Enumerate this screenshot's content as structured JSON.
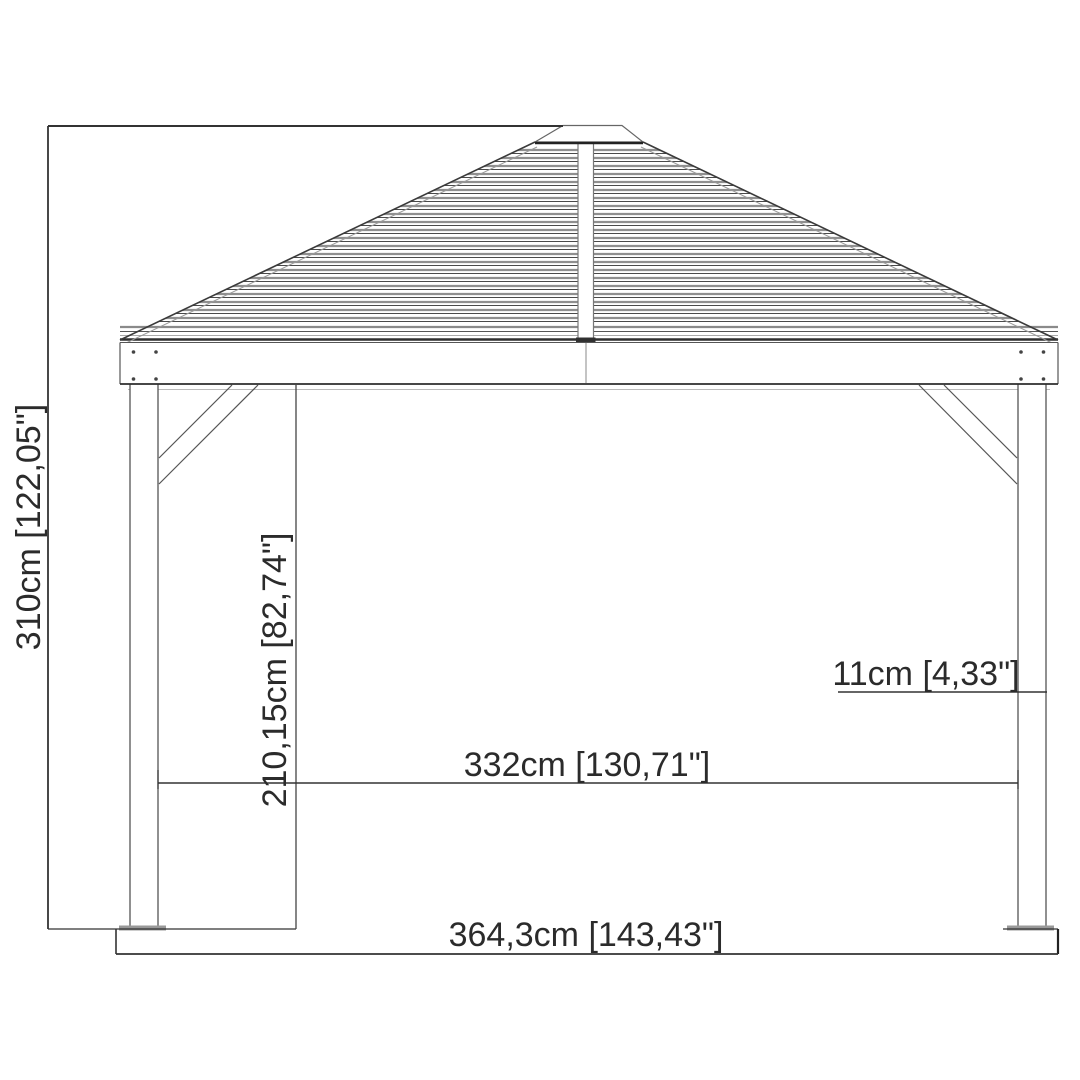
{
  "diagram": {
    "type": "technical-elevation-drawing",
    "subject": "gazebo",
    "dimensions": {
      "total_height": "310cm [122,05\"]",
      "clear_height": "210,15cm [82,74\"]",
      "inner_width": "332cm [130,71\"]",
      "post_width": "11cm [4,33\"]",
      "total_width": "364,3cm [143,43\"]"
    },
    "ink_color": "#3a3a3a",
    "background_color": "#ffffff"
  }
}
